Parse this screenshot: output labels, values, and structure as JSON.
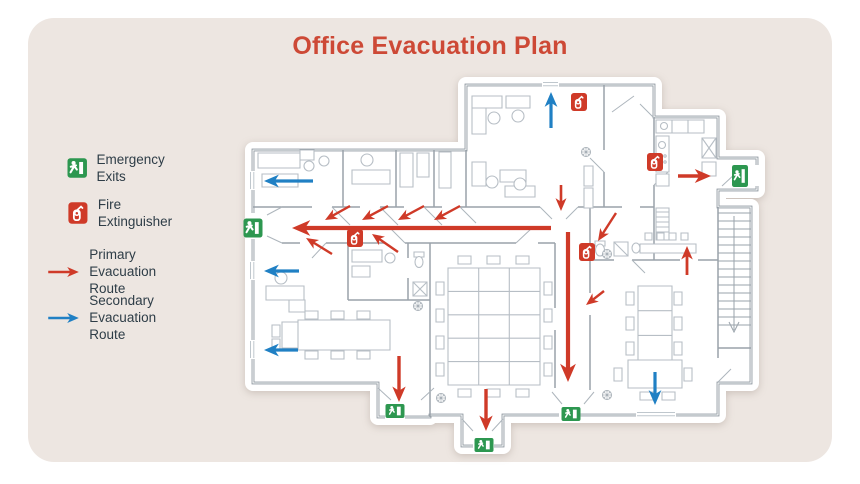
{
  "title": "Office Evacuation Plan",
  "colors": {
    "background": "#FFFFFF",
    "card": "#EDE6E1",
    "title": "#CD4936",
    "text": "#2E3D47",
    "primary_route": "#CF3A28",
    "secondary_route": "#2080C4",
    "exit_green": "#2D9750",
    "extinguisher_red": "#CF3A28",
    "wall": "#8A949C",
    "furniture": "#B7BEC5"
  },
  "legend": {
    "items": [
      {
        "icon": "emergency-exit-icon",
        "label": "Emergency Exits",
        "lines": [
          "Emergency Exits"
        ]
      },
      {
        "icon": "fire-extinguisher-icon",
        "label": "Fire Extinguisher",
        "lines": [
          "Fire Extinguisher"
        ]
      },
      {
        "icon": "primary-route-arrow",
        "label": "Primary Evacuation Route",
        "lines": [
          "Primary",
          "Evacuation Route"
        ]
      },
      {
        "icon": "secondary-route-arrow",
        "label": "Secondary Evacuation Route",
        "lines": [
          "Secondary",
          "Evacuation Route"
        ]
      }
    ]
  },
  "plan": {
    "exits": [
      {
        "x": 253,
        "y": 228,
        "w": 19,
        "h": 19
      },
      {
        "x": 740,
        "y": 176,
        "w": 16,
        "h": 22
      },
      {
        "x": 395,
        "y": 411,
        "w": 19,
        "h": 14
      },
      {
        "x": 484,
        "y": 445,
        "w": 19,
        "h": 14
      },
      {
        "x": 571,
        "y": 414,
        "w": 19,
        "h": 14
      }
    ],
    "extinguishers": [
      {
        "x": 579,
        "y": 102,
        "w": 16,
        "h": 18
      },
      {
        "x": 655,
        "y": 162,
        "w": 16,
        "h": 18
      },
      {
        "x": 355,
        "y": 238,
        "w": 16,
        "h": 18
      },
      {
        "x": 587,
        "y": 252,
        "w": 16,
        "h": 18
      }
    ],
    "primary_arrows": [
      {
        "x1": 551,
        "y1": 228,
        "x2": 292,
        "y2": 228,
        "w": 4.2
      },
      {
        "x1": 350,
        "y1": 206,
        "x2": 325,
        "y2": 220,
        "w": 2.4
      },
      {
        "x1": 388,
        "y1": 206,
        "x2": 362,
        "y2": 220,
        "w": 2.4
      },
      {
        "x1": 424,
        "y1": 206,
        "x2": 398,
        "y2": 220,
        "w": 2.4
      },
      {
        "x1": 460,
        "y1": 206,
        "x2": 434,
        "y2": 220,
        "w": 2.4
      },
      {
        "x1": 332,
        "y1": 254,
        "x2": 306,
        "y2": 238,
        "w": 2.4
      },
      {
        "x1": 398,
        "y1": 252,
        "x2": 372,
        "y2": 234,
        "w": 2.4
      },
      {
        "x1": 561,
        "y1": 185,
        "x2": 561,
        "y2": 211,
        "w": 2.6
      },
      {
        "x1": 568,
        "y1": 232,
        "x2": 568,
        "y2": 382,
        "w": 4.2
      },
      {
        "x1": 616,
        "y1": 213,
        "x2": 598,
        "y2": 241,
        "w": 2.4
      },
      {
        "x1": 604,
        "y1": 291,
        "x2": 586,
        "y2": 305,
        "w": 2.4
      },
      {
        "x1": 399,
        "y1": 356,
        "x2": 399,
        "y2": 402,
        "w": 3.4
      },
      {
        "x1": 486,
        "y1": 389,
        "x2": 486,
        "y2": 431,
        "w": 3.4
      },
      {
        "x1": 678,
        "y1": 176,
        "x2": 711,
        "y2": 176,
        "w": 3.6
      },
      {
        "x1": 687,
        "y1": 275,
        "x2": 687,
        "y2": 246,
        "w": 2.8
      }
    ],
    "secondary_arrows": [
      {
        "x1": 313,
        "y1": 181,
        "x2": 264,
        "y2": 181,
        "w": 3.2
      },
      {
        "x1": 299,
        "y1": 271,
        "x2": 264,
        "y2": 271,
        "w": 3.2
      },
      {
        "x1": 298,
        "y1": 350,
        "x2": 264,
        "y2": 350,
        "w": 3.2
      },
      {
        "x1": 551,
        "y1": 128,
        "x2": 551,
        "y2": 92,
        "w": 3.2
      },
      {
        "x1": 655,
        "y1": 372,
        "x2": 655,
        "y2": 405,
        "w": 3.2
      }
    ],
    "plants": [
      [
        418,
        306
      ],
      [
        441,
        398
      ],
      [
        607,
        395
      ],
      [
        586,
        152
      ],
      [
        607,
        254
      ]
    ]
  }
}
